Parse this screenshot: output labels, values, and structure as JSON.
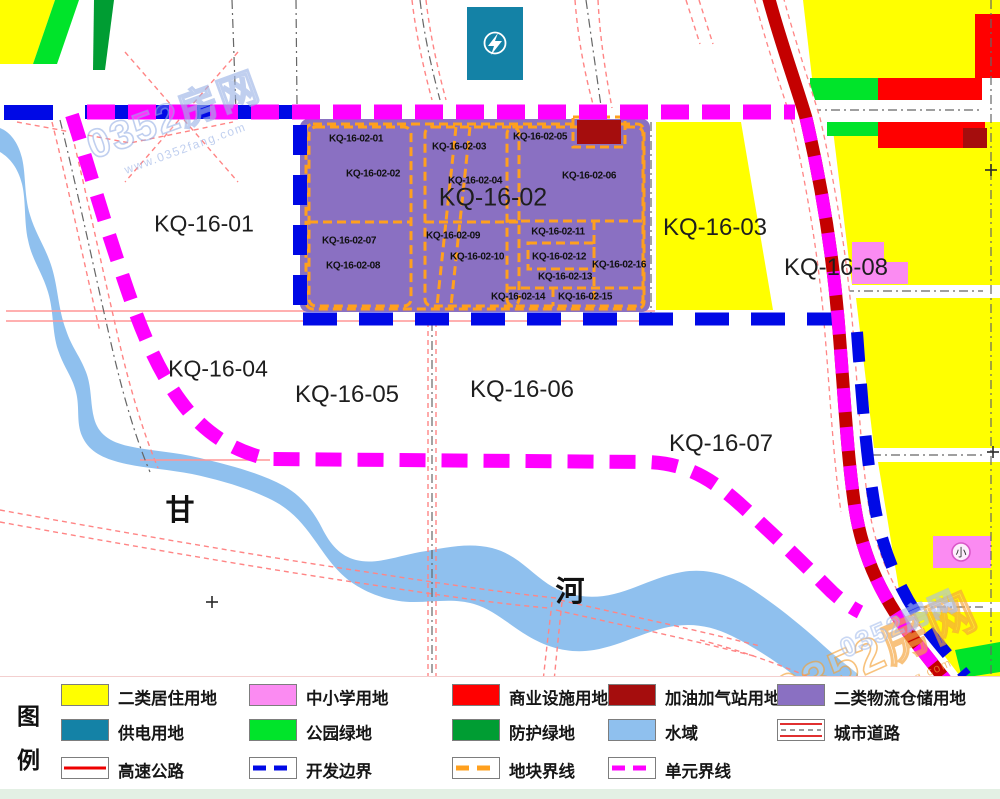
{
  "map": {
    "zone_labels": [
      {
        "text": "KQ-16-01",
        "x": 204,
        "y": 224,
        "size": 23
      },
      {
        "text": "KQ-16-02",
        "x": 493,
        "y": 198,
        "size": 25
      },
      {
        "text": "KQ-16-03",
        "x": 715,
        "y": 228,
        "size": 24
      },
      {
        "text": "KQ-16-04",
        "x": 218,
        "y": 369,
        "size": 23
      },
      {
        "text": "KQ-16-05",
        "x": 347,
        "y": 395,
        "size": 24
      },
      {
        "text": "KQ-16-06",
        "x": 522,
        "y": 390,
        "size": 24
      },
      {
        "text": "KQ-16-07",
        "x": 721,
        "y": 444,
        "size": 24
      },
      {
        "text": "KQ-16-08",
        "x": 836,
        "y": 268,
        "size": 24
      }
    ],
    "parcel_labels": [
      {
        "text": "KQ-16-02-01",
        "x": 356,
        "y": 139
      },
      {
        "text": "KQ-16-02-02",
        "x": 373,
        "y": 174
      },
      {
        "text": "KQ-16-02-03",
        "x": 459,
        "y": 147
      },
      {
        "text": "KQ-16-02-04",
        "x": 475,
        "y": 181
      },
      {
        "text": "KQ-16-02-05",
        "x": 540,
        "y": 137
      },
      {
        "text": "KQ-16-02-06",
        "x": 589,
        "y": 176
      },
      {
        "text": "KQ-16-02-07",
        "x": 349,
        "y": 241
      },
      {
        "text": "KQ-16-02-08",
        "x": 353,
        "y": 266
      },
      {
        "text": "KQ-16-02-09",
        "x": 453,
        "y": 236
      },
      {
        "text": "KQ-16-02-10",
        "x": 477,
        "y": 257
      },
      {
        "text": "KQ-16-02-11",
        "x": 558,
        "y": 232
      },
      {
        "text": "KQ-16-02-12",
        "x": 559,
        "y": 257
      },
      {
        "text": "KQ-16-02-13",
        "x": 565,
        "y": 277
      },
      {
        "text": "KQ-16-02-14",
        "x": 518,
        "y": 297
      },
      {
        "text": "KQ-16-02-15",
        "x": 585,
        "y": 297
      },
      {
        "text": "KQ-16-02-16",
        "x": 619,
        "y": 265
      }
    ],
    "river_name_chars": [
      {
        "text": "甘",
        "x": 180,
        "y": 508
      },
      {
        "text": "河",
        "x": 570,
        "y": 589
      }
    ],
    "school_icon_char": "小"
  },
  "legend": {
    "title_chars": [
      {
        "text": "图",
        "x": 17,
        "y": 20
      },
      {
        "text": "例",
        "x": 17,
        "y": 64
      }
    ],
    "columns": [
      61,
      249,
      452,
      608,
      777
    ],
    "rows": [
      7,
      42,
      80
    ],
    "items": [
      {
        "label": "二类居住用地",
        "type": "fill",
        "color": "#ffff00",
        "col": 0,
        "row": 0
      },
      {
        "label": "中小学用地",
        "type": "fill",
        "color": "#fb8bf2",
        "col": 1,
        "row": 0
      },
      {
        "label": "商业设施用地",
        "type": "fill",
        "color": "#ff0000",
        "col": 2,
        "row": 0
      },
      {
        "label": "加油加气站用地",
        "type": "fill",
        "color": "#a50d0d",
        "col": 3,
        "row": 0
      },
      {
        "label": "二类物流仓储用地",
        "type": "fill",
        "color": "#8a70c2",
        "col": 4,
        "row": 0
      },
      {
        "label": "供电用地",
        "type": "fill",
        "color": "#1482a6",
        "col": 0,
        "row": 1
      },
      {
        "label": "公园绿地",
        "type": "fill",
        "color": "#00e42a",
        "col": 1,
        "row": 1
      },
      {
        "label": "防护绿地",
        "type": "fill",
        "color": "#009d33",
        "col": 2,
        "row": 1
      },
      {
        "label": "水域",
        "type": "fill",
        "color": "#8fc0ee",
        "col": 3,
        "row": 1
      },
      {
        "label": "城市道路",
        "type": "city-road",
        "color": "#e03030",
        "col": 4,
        "row": 1
      },
      {
        "label": "高速公路",
        "type": "highway",
        "color": "#ee0000",
        "col": 0,
        "row": 2
      },
      {
        "label": "开发边界",
        "type": "dash",
        "color": "#0009e6",
        "col": 1,
        "row": 2
      },
      {
        "label": "地块界线",
        "type": "dash",
        "color": "#ffa01e",
        "col": 2,
        "row": 2
      },
      {
        "label": "单元界线",
        "type": "dash",
        "color": "#ff00ff",
        "col": 3,
        "row": 2
      }
    ]
  },
  "watermarks": [
    {
      "text": "0352房网",
      "sub": "www.0352fang.com",
      "x": 175,
      "y": 120,
      "rot": -20,
      "size": 40,
      "color": "rgba(150,175,228,0.75)"
    },
    {
      "text": "0352房网",
      "sub": "www.0352fang.com",
      "x": 878,
      "y": 655,
      "rot": -24,
      "size": 48,
      "color": "rgba(244,160,52,0.8)"
    },
    {
      "text": "0352房网",
      "sub": "",
      "x": 898,
      "y": 622,
      "rot": -24,
      "size": 27,
      "color": "rgba(160,185,235,0.7)"
    }
  ],
  "colors": {
    "residential": "#ffff00",
    "school": "#fb8bf2",
    "commercial": "#ff0000",
    "gas_station": "#a50d0d",
    "logistics": "#8a70c2",
    "power": "#1482a6",
    "park_green": "#00e42a",
    "protective_green": "#009d33",
    "water": "#8fc0ee",
    "highway": "#c40000",
    "unit_boundary": "#ff00ff",
    "dev_boundary": "#0009e6",
    "parcel_boundary": "#ffa01e",
    "city_road": "#ff8585"
  }
}
